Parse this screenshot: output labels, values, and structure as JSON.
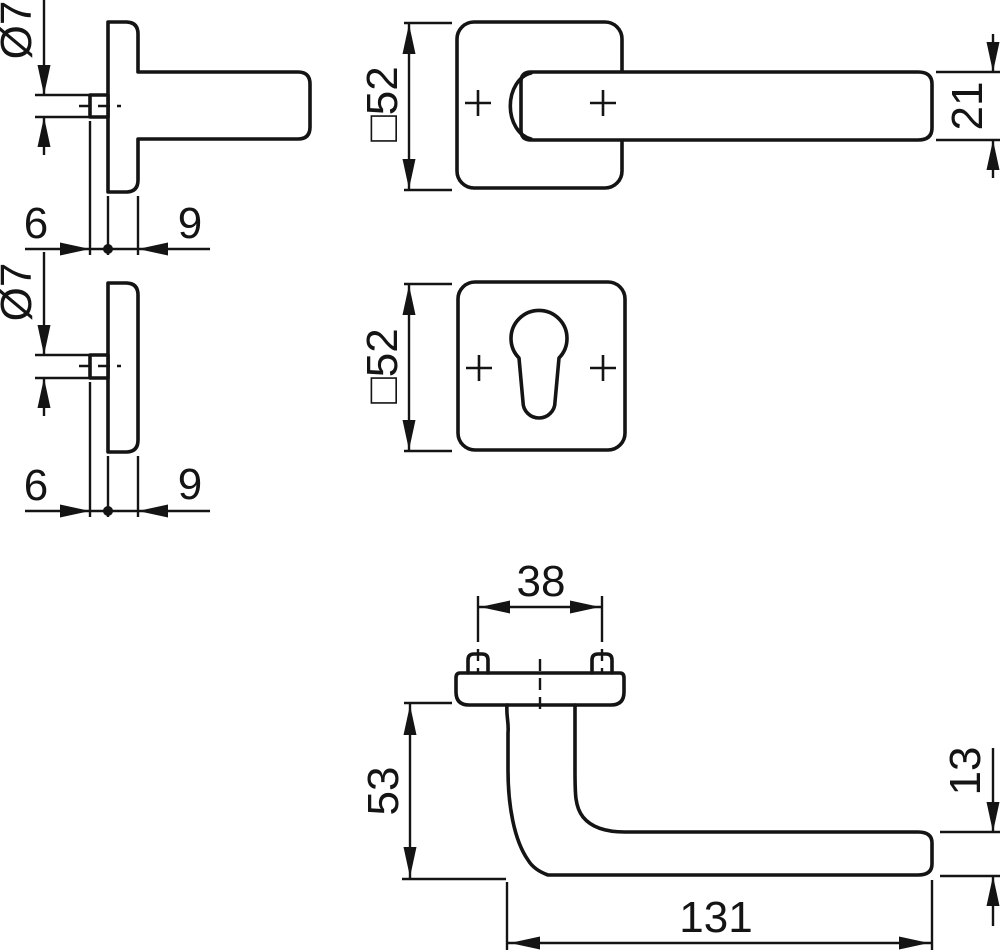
{
  "drawing": {
    "background": "#ffffff",
    "line_color": "#141414",
    "kind": "door-handle-rosette-dimension-drawing",
    "labels": {
      "lever_rose_side": {
        "spindle_square": "Ø7",
        "hub_projection": "6",
        "rose_thickness": "9"
      },
      "lever_rose_front": {
        "rose_size": "□52",
        "lever_width": "21"
      },
      "key_rose_side": {
        "spindle_square": "Ø7",
        "hub_projection": "6",
        "rose_thickness": "9"
      },
      "key_rose_front": {
        "rose_size": "□52"
      },
      "lever_profile": {
        "screw_spacing": "38",
        "projection": "53",
        "grip_thickness": "13",
        "lever_length": "131"
      }
    }
  }
}
